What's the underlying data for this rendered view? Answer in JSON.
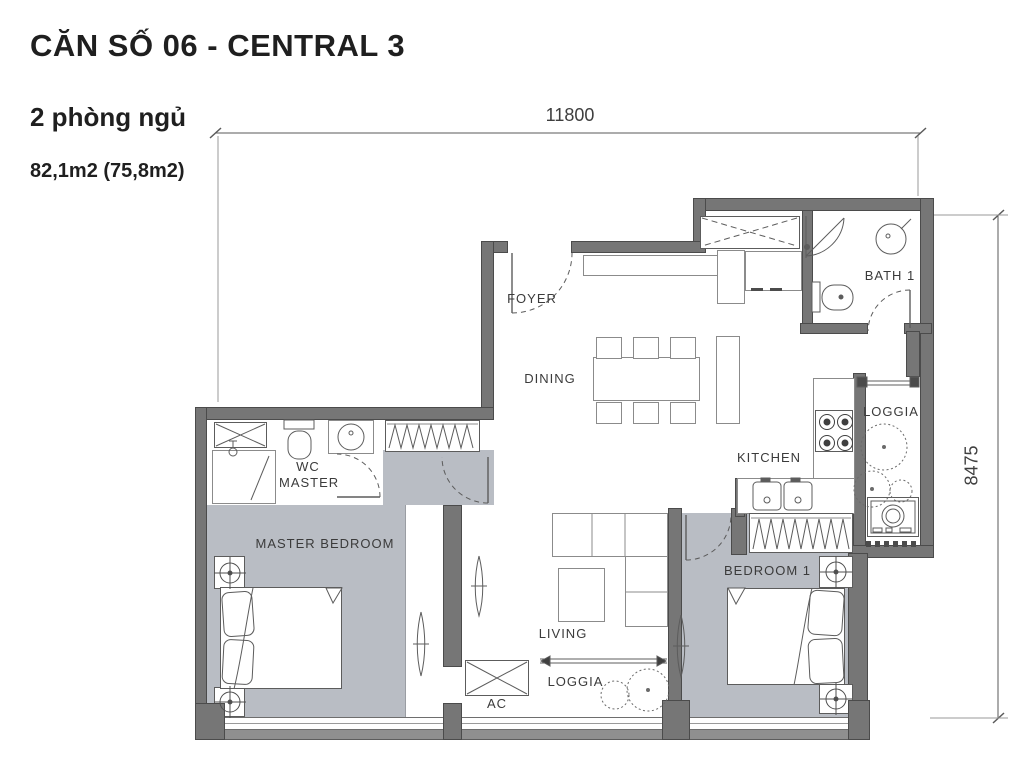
{
  "header": {
    "title": "CĂN SỐ 06 - CENTRAL 3",
    "subtitle": "2 phòng ngủ",
    "area": "82,1m2 (75,8m2)"
  },
  "dimensions": {
    "width_mm": "11800",
    "height_mm": "8475"
  },
  "rooms": {
    "foyer": {
      "label": "FOYER"
    },
    "dining": {
      "label": "DINING"
    },
    "bath1": {
      "label": "BATH 1"
    },
    "loggia_top": {
      "label": "LOGGIA"
    },
    "kitchen": {
      "label": "KITCHEN"
    },
    "wc_master": {
      "label": "WC MASTER"
    },
    "master_bedroom": {
      "label": "MASTER BEDROOM"
    },
    "living": {
      "label": "LIVING"
    },
    "bedroom1": {
      "label": "BEDROOM 1"
    },
    "loggia_bottom": {
      "label": "LOGGIA"
    },
    "ac": {
      "label": "AC"
    }
  },
  "colors": {
    "wall": "#767676",
    "wall_edge": "#4b4b4b",
    "bedroom_floor": "#b9bdc4",
    "line": "#5c5c5c",
    "text": "#3b3b3b"
  }
}
